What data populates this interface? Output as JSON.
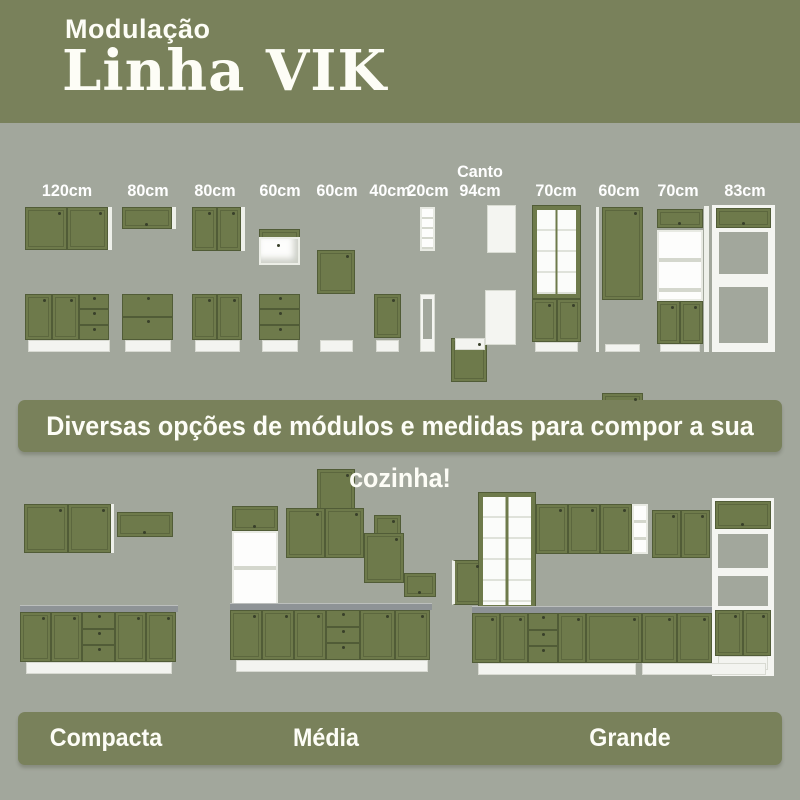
{
  "header": {
    "kicker": "Modulação",
    "title": "Linha VIK"
  },
  "modules": {
    "labels": [
      {
        "top": "",
        "main": "120cm"
      },
      {
        "top": "",
        "main": "80cm"
      },
      {
        "top": "",
        "main": "80cm"
      },
      {
        "top": "",
        "main": "60cm"
      },
      {
        "top": "",
        "main": "60cm"
      },
      {
        "top": "",
        "main": "40cm"
      },
      {
        "top": "",
        "main": "20cm"
      },
      {
        "top": "Canto",
        "main": "94cm"
      },
      {
        "top": "",
        "main": "70cm"
      },
      {
        "top": "",
        "main": "60cm"
      },
      {
        "top": "",
        "main": "70cm"
      },
      {
        "top": "",
        "main": "83cm"
      }
    ]
  },
  "banner": {
    "text": "Diversas opções de módulos e medidas para compor a sua cozinha!"
  },
  "kitchens": {
    "items": [
      {
        "label": "Compacta"
      },
      {
        "label": "Média"
      },
      {
        "label": "Grande"
      }
    ]
  },
  "colors": {
    "header_green": "#79815b",
    "background": "#a2a79c",
    "cabinet_green": "#6e7a4b",
    "cabinet_green_dark": "#515c37",
    "carcass_white": "#f4f5f1",
    "countertop_gray": "#8e9396"
  }
}
